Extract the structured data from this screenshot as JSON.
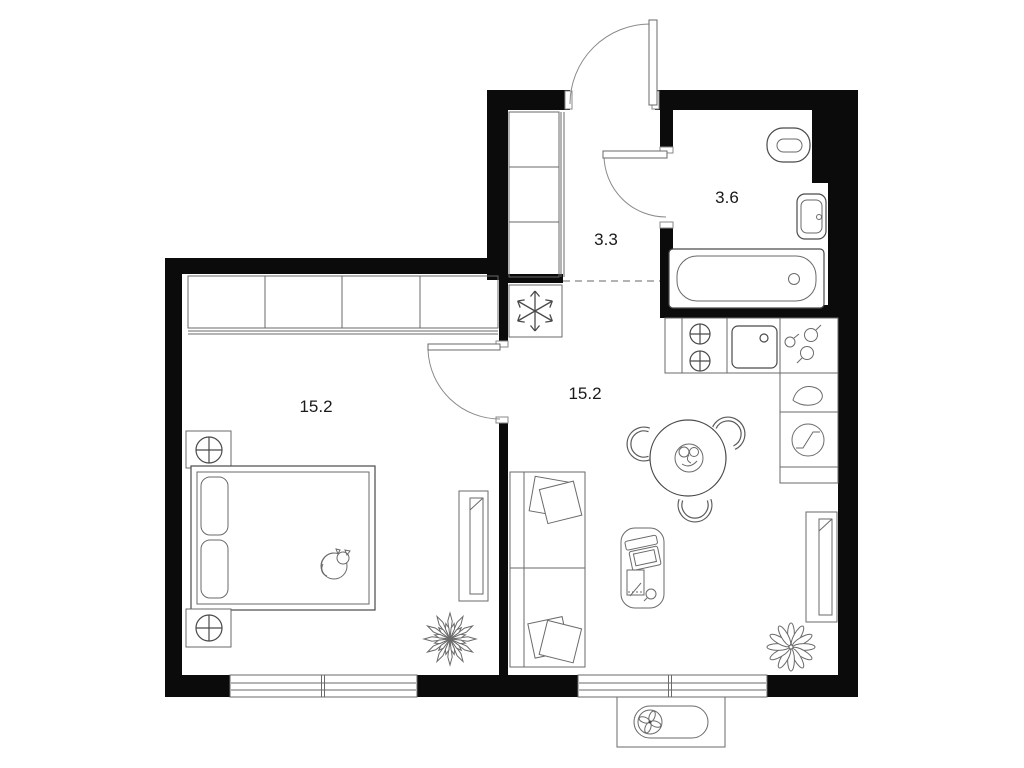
{
  "plan": {
    "type": "apartment-floor-plan",
    "rooms": [
      {
        "id": "bedroom",
        "label": "15.2"
      },
      {
        "id": "living-kitchen",
        "label": "15.2"
      },
      {
        "id": "hallway",
        "label": "3.3"
      },
      {
        "id": "bathroom",
        "label": "3.6"
      }
    ]
  },
  "colors": {
    "background": "#ffffff",
    "walls": "#0b0b0b",
    "furniture_line": "#4a4a4a",
    "label_text": "#1a1a1a",
    "dashed_divider": "#9a9a9a"
  }
}
